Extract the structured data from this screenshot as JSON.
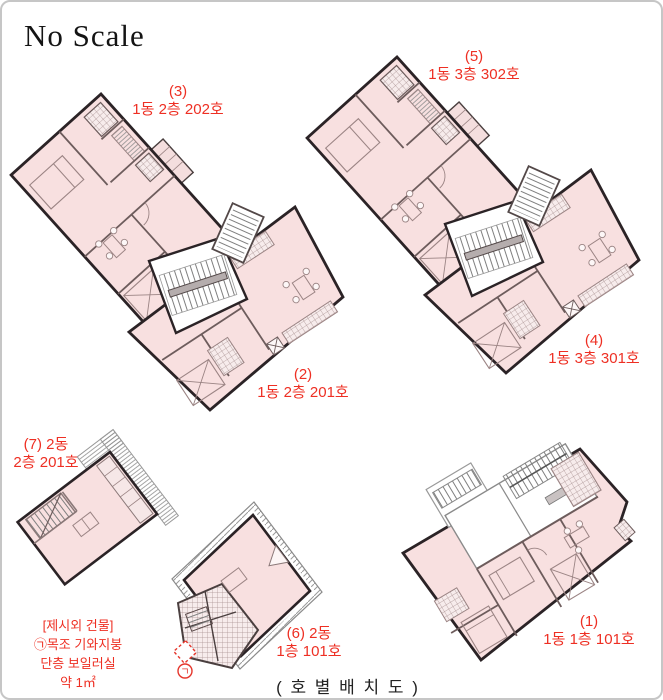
{
  "page": {
    "scale_note": "No Scale",
    "caption": "( 호 별 배 치 도 )"
  },
  "unit_labels": {
    "u1": {
      "line1": "(1)",
      "line2": "1동 1층 101호"
    },
    "u2": {
      "line1": "(2)",
      "line2": "1동 2층 201호"
    },
    "u3": {
      "line1": "(3)",
      "line2": "1동 2층 202호"
    },
    "u4": {
      "line1": "(4)",
      "line2": "1동 3층 301호"
    },
    "u5": {
      "line1": "(5)",
      "line2": "1동 3층 302호"
    },
    "u6": {
      "line1": "(6) 2동",
      "line2": "1층 101호"
    },
    "u7": {
      "line1": "(7) 2동",
      "line2": "2층 201호"
    }
  },
  "annotation": {
    "line1": "[제시외 건물]",
    "line2": "㉠목조 기와지붕",
    "line3": "단층 보일러실",
    "line4": "약 1㎡",
    "marker": "ㄱ"
  },
  "colors": {
    "label_red": "#ee2f23",
    "plan_pink": "#f8e0e0",
    "wall_dark": "#2b2326",
    "wall_inner": "#6d5c5c"
  }
}
